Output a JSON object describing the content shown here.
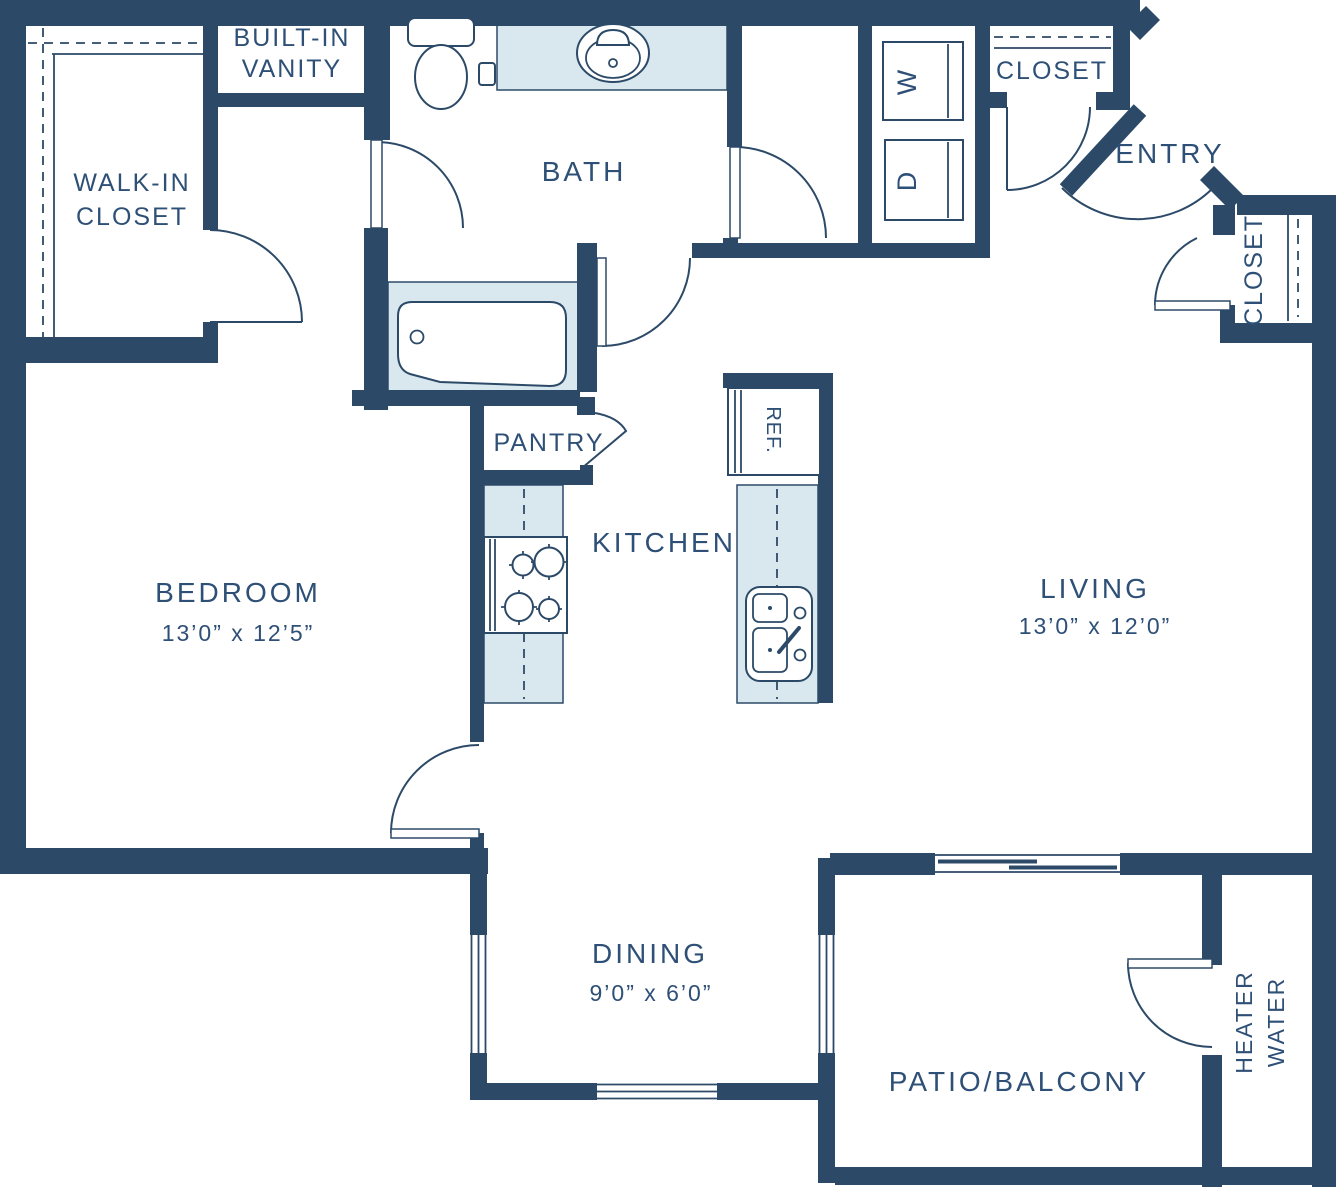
{
  "title": "Apartment Floor Plan",
  "colors": {
    "wall": "#2C4A68",
    "fixture_fill": "#D9E8EF",
    "text": "#2E5077",
    "background": "#FFFFFF"
  },
  "rooms": {
    "bedroom": {
      "label": "BEDROOM",
      "dimensions": "13’0” x 12’5”"
    },
    "living": {
      "label": "LIVING",
      "dimensions": "13’0” x 12’0”"
    },
    "dining": {
      "label": "DINING",
      "dimensions": "9’0” x 6’0”"
    },
    "bath": {
      "label": "BATH"
    },
    "kitchen": {
      "label": "KITCHEN"
    },
    "entry": {
      "label": "ENTRY"
    },
    "patio": {
      "label": "PATIO/BALCONY"
    },
    "walk_in_closet": {
      "line1": "WALK-IN",
      "line2": "CLOSET"
    },
    "built_in_vanity": {
      "line1": "BUILT-IN",
      "line2": "VANITY"
    },
    "pantry": {
      "label": "PANTRY"
    },
    "closet_hall": {
      "label": "CLOSET"
    },
    "closet_entry": {
      "label": "CLOSET"
    },
    "water_heater": {
      "line1": "WATER",
      "line2": "HEATER"
    },
    "laundry": {
      "washer_label": "W",
      "dryer_label": "D"
    },
    "refrigerator": {
      "label": "REF."
    }
  }
}
